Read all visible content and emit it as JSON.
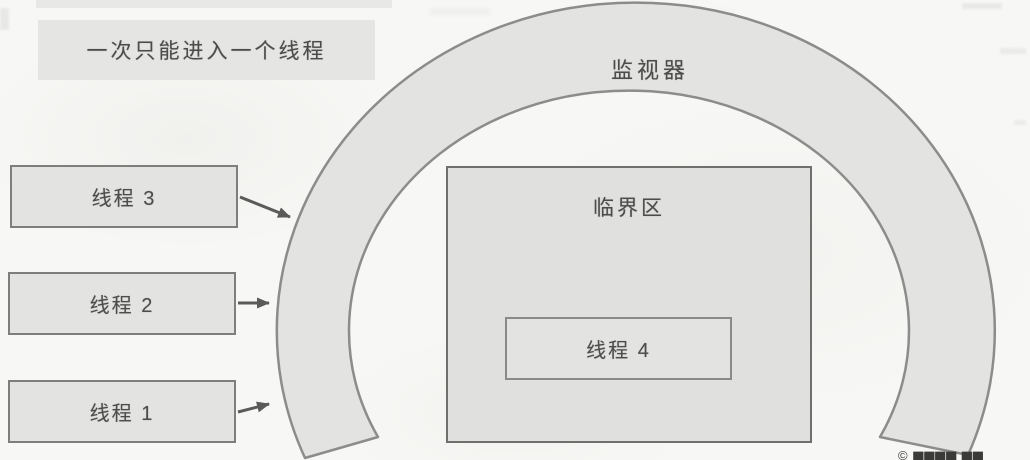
{
  "figure": {
    "caption_box": {
      "label": "一次只能进入一个线程"
    },
    "monitor": {
      "label": "监视器"
    },
    "critical_section": {
      "label": "临界区"
    },
    "waiting_threads": [
      {
        "label": "线程 3"
      },
      {
        "label": "线程 2"
      },
      {
        "label": "线程 1"
      }
    ],
    "thread_in_monitor": {
      "label": "线程 4"
    },
    "watermark": {
      "text": "© ▆▆▆▆ ▆▆"
    },
    "colors": {
      "page_background": "#f7f7f5",
      "box_fill": "#e3e3e1",
      "box_border": "#7e7e7c",
      "critical_fill": "#e0e0de",
      "ring_fill": "#e3e3e1",
      "ring_stroke": "#8c8c8a",
      "text": "#4c4c4a",
      "arrow": "#5a5a58"
    }
  }
}
